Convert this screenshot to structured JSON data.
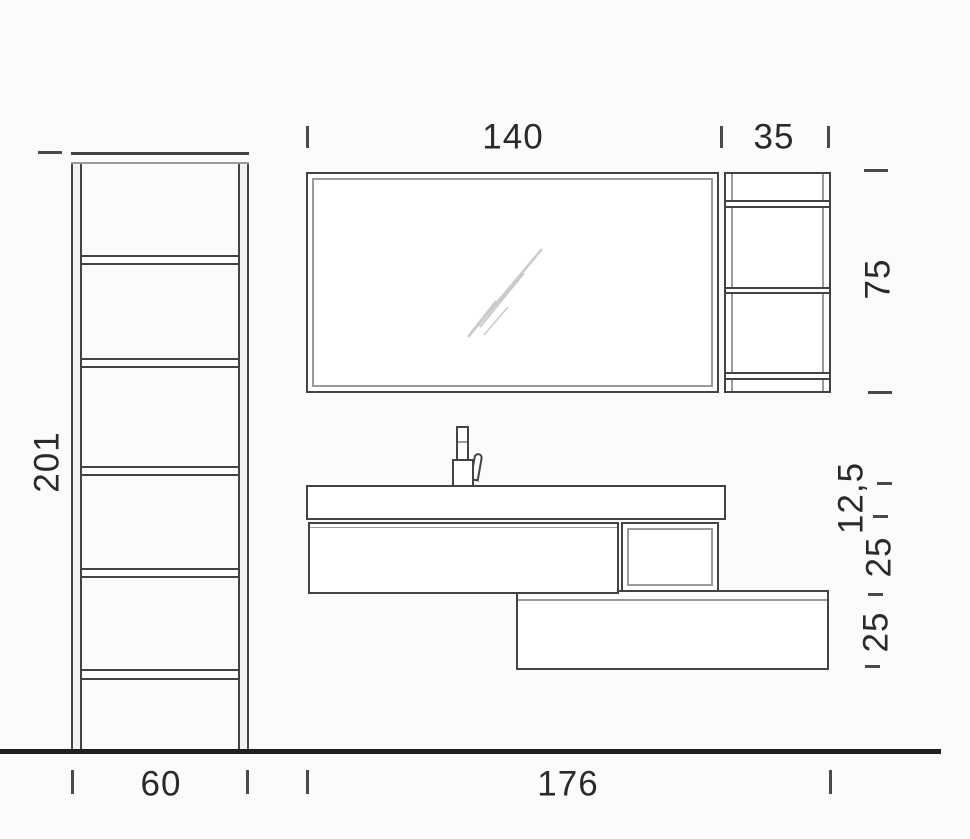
{
  "drawing": {
    "type": "bathroom-furniture-technical-drawing",
    "labels": {
      "mirror_width": "140",
      "side_shelf_width": "35",
      "side_shelf_height": "75",
      "tall_unit_height": "201",
      "tall_unit_width": "60",
      "vanity_total_width": "176",
      "countertop_thickness": "12,5",
      "upper_cabinet_height": "25",
      "lower_cabinet_height": "25"
    }
  },
  "colors": {
    "bg": "#fbfbfb",
    "line": "#434343",
    "line_light": "#9a9a9a",
    "dim": "#4a4a4a",
    "ground": "#1f1f1f",
    "text": "#2a2a2a",
    "glare": "#c7ccc7"
  }
}
